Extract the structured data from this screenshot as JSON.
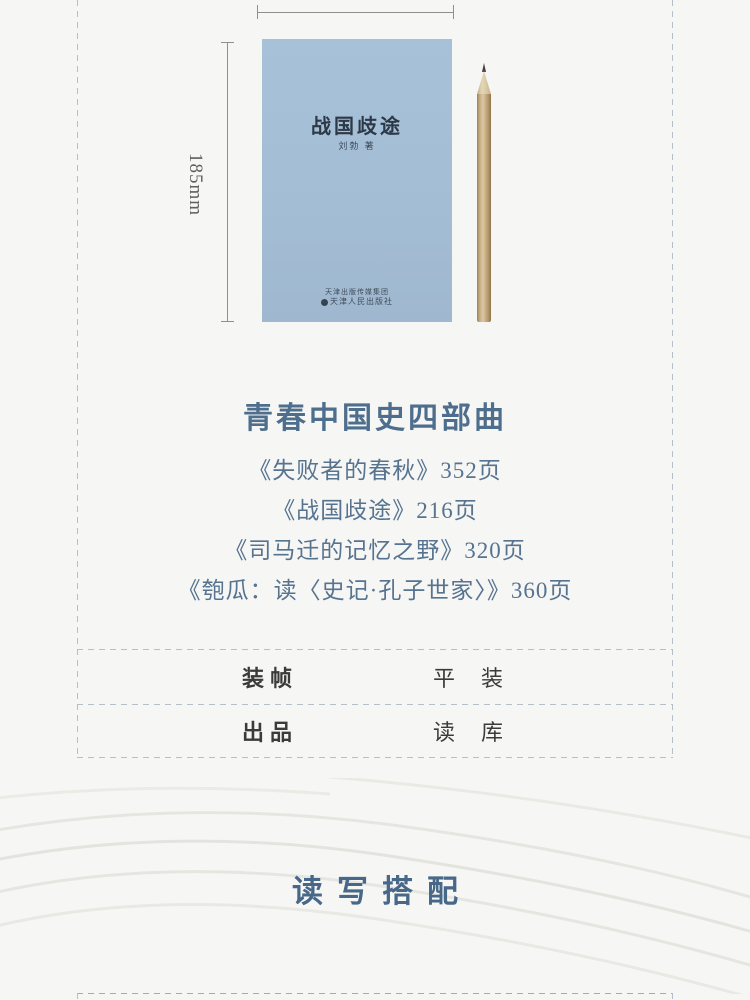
{
  "page": {
    "background": "#f6f6f4",
    "accent_blue": "#4e6e8d",
    "cover_blue": "#a3bdd5",
    "dash_color": "#b5bfc9"
  },
  "measurements": {
    "height_label": "185mm"
  },
  "book_cover": {
    "title": "战国歧途",
    "author": "刘勃 著",
    "publisher_group": "天津出版传媒集团",
    "publisher": "天津人民出版社"
  },
  "series": {
    "heading": "青春中国史四部曲",
    "books": [
      {
        "text": "《失败者的春秋》352页"
      },
      {
        "text": "《战国歧途》216页"
      },
      {
        "text": "《司马迁的记忆之野》320页"
      },
      {
        "text": "《匏瓜：读〈史记·孔子世家〉》360页"
      }
    ]
  },
  "specs": {
    "rows": [
      {
        "label": "装帧",
        "value": "平　装"
      },
      {
        "label": "出品",
        "value": "读　库"
      }
    ]
  },
  "section_title": {
    "text": "读写搭配"
  }
}
